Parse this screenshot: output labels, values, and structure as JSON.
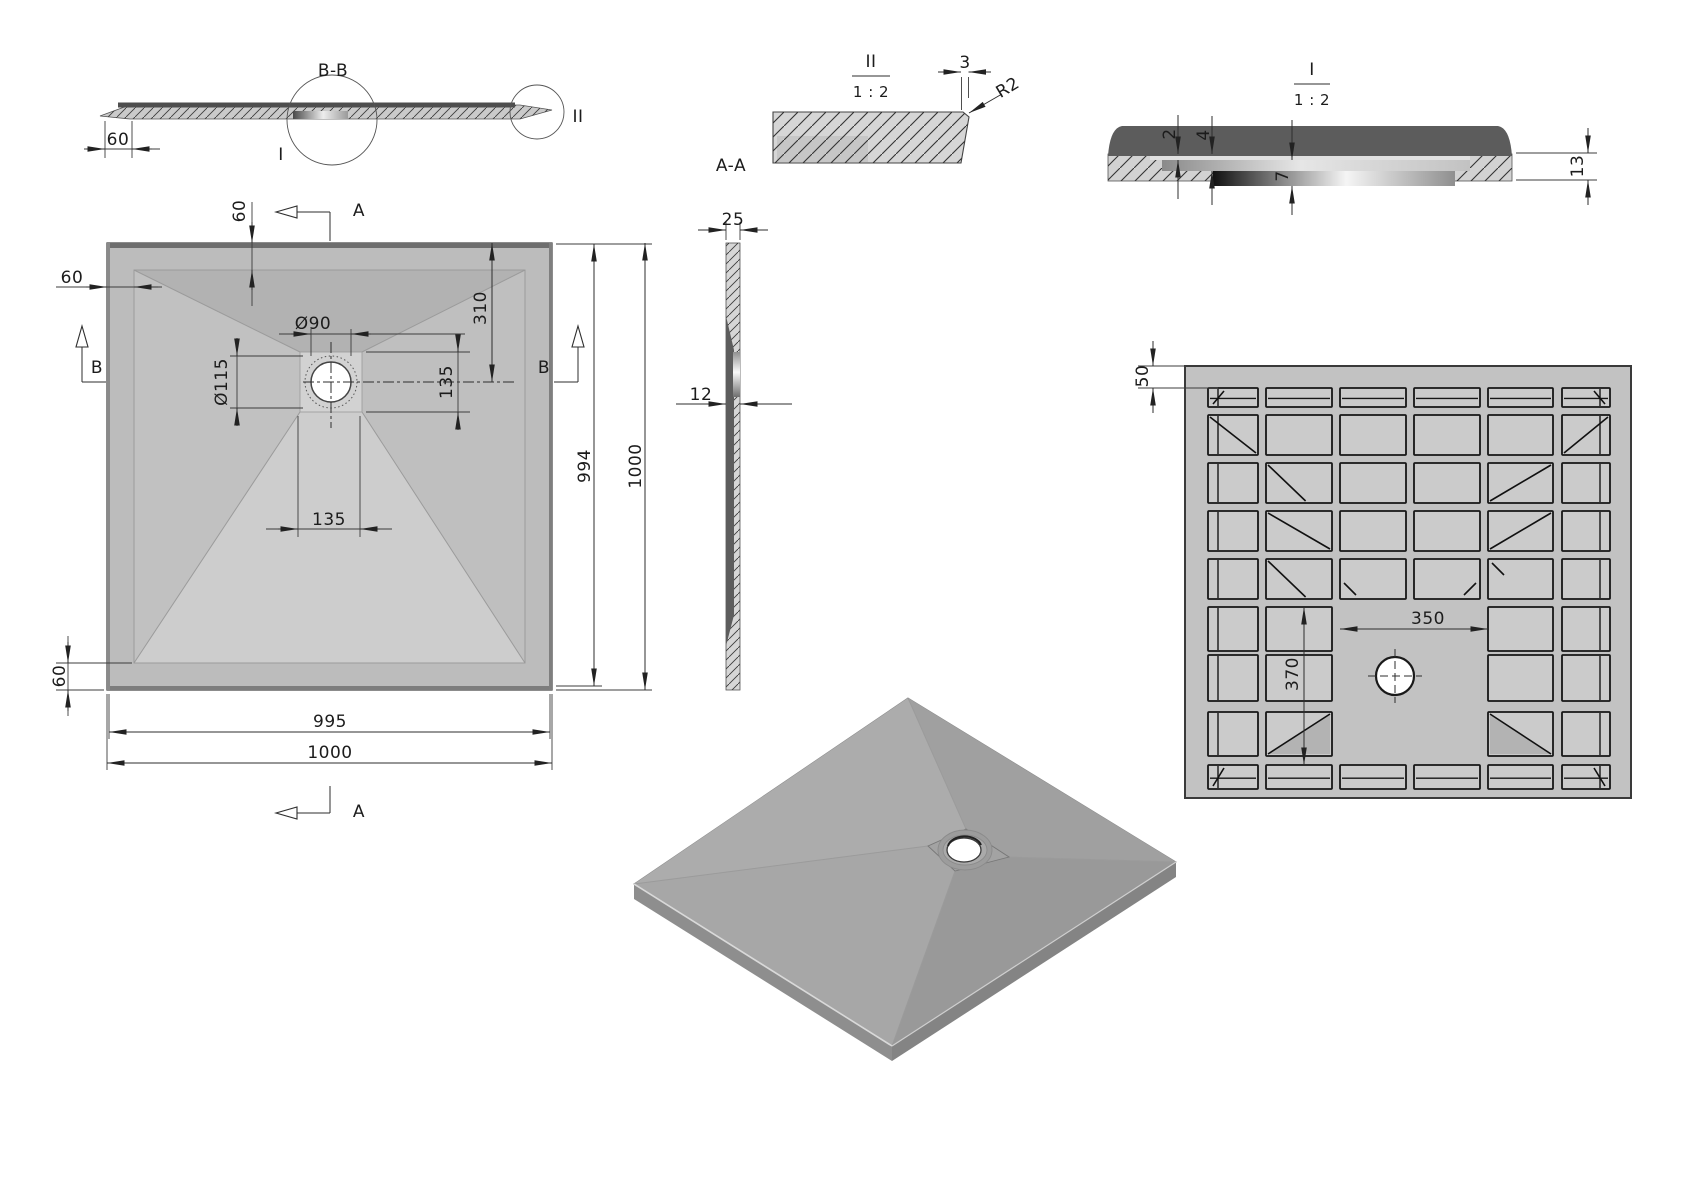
{
  "palette": {
    "background": "#ffffff",
    "line": "#2e2e2e",
    "dark_surface": "#5c5c5c",
    "body_gray": "#c6c6c6",
    "rim_gray": "#bcbcbc",
    "pocket_gray": "#cbcbcb",
    "drain_white": "#ffffff"
  },
  "titles": {
    "section_bb": "B-B",
    "detail_ii": "II",
    "detail_i": "I",
    "section_aa": "A-A",
    "detail_scale": "1 : 2"
  },
  "section_bb": {
    "dim_left_offset": "60",
    "detail_marker_large": "I",
    "detail_marker_small": "II"
  },
  "detail_ii": {
    "dim_lip_width": "3",
    "radius_callout": "R2"
  },
  "detail_i": {
    "dim_top_layer": "2",
    "dim_seat_depth": "4",
    "dim_drain_depth": "7",
    "dim_edge_height": "13"
  },
  "section_aa": {
    "dim_edge_thickness": "25",
    "dim_center_thickness": "12"
  },
  "plan_view": {
    "cut_label_a": "A",
    "cut_label_b": "B",
    "dim_top_slope": "60",
    "dim_left_slope": "60",
    "dim_bottom_slope": "60",
    "dim_drain_hole": "Ø90",
    "dim_drain_recess": "Ø115",
    "dim_recess_height": "135",
    "dim_drain_from_top": "310",
    "dim_recess_width": "135",
    "dim_inner_length": "994",
    "dim_side_length": "1000",
    "dim_bottom_inner": "995",
    "dim_bottom_length": "1000"
  },
  "bottom_view": {
    "dim_edge_rib": "50",
    "dim_drain_zone_width": "350",
    "dim_drain_zone_height": "370",
    "grid": {
      "x": 1185,
      "y": 366,
      "w": 446,
      "h": 432,
      "col_x": [
        1208,
        1266,
        1340,
        1414,
        1488,
        1562
      ],
      "col_w": [
        50,
        66,
        66,
        66,
        65,
        48
      ],
      "row_y": [
        388,
        415,
        463,
        511,
        559,
        607,
        655,
        712,
        765
      ],
      "row_h": [
        19,
        40,
        40,
        40,
        40,
        44,
        46,
        44,
        24
      ],
      "skip_cols": [
        2,
        3
      ],
      "skip_rows": [
        5,
        6,
        7
      ],
      "short_rows": [
        0,
        8
      ],
      "edge_cols": [
        0,
        5
      ],
      "diagonals": [
        {
          "c": 0,
          "r": 0,
          "t": "tickL"
        },
        {
          "c": 5,
          "r": 0,
          "t": "tickR"
        },
        {
          "c": 0,
          "r": 1,
          "t": "bs"
        },
        {
          "c": 5,
          "r": 1,
          "t": "fs"
        },
        {
          "c": 1,
          "r": 2,
          "t": "bsHalf"
        },
        {
          "c": 4,
          "r": 2,
          "t": "fs"
        },
        {
          "c": 1,
          "r": 3,
          "t": "bs"
        },
        {
          "c": 4,
          "r": 3,
          "t": "fs"
        },
        {
          "c": 1,
          "r": 4,
          "t": "bsHalf"
        },
        {
          "c": 2,
          "r": 4,
          "t": "tickBL"
        },
        {
          "c": 3,
          "r": 4,
          "t": "tickBR"
        },
        {
          "c": 4,
          "r": 4,
          "t": "tickTL"
        },
        {
          "c": 1,
          "r": 7,
          "t": "fsShade"
        },
        {
          "c": 4,
          "r": 7,
          "t": "bsShade"
        },
        {
          "c": 0,
          "r": 8,
          "t": "tickL"
        },
        {
          "c": 5,
          "r": 8,
          "t": "tickR"
        }
      ]
    }
  }
}
